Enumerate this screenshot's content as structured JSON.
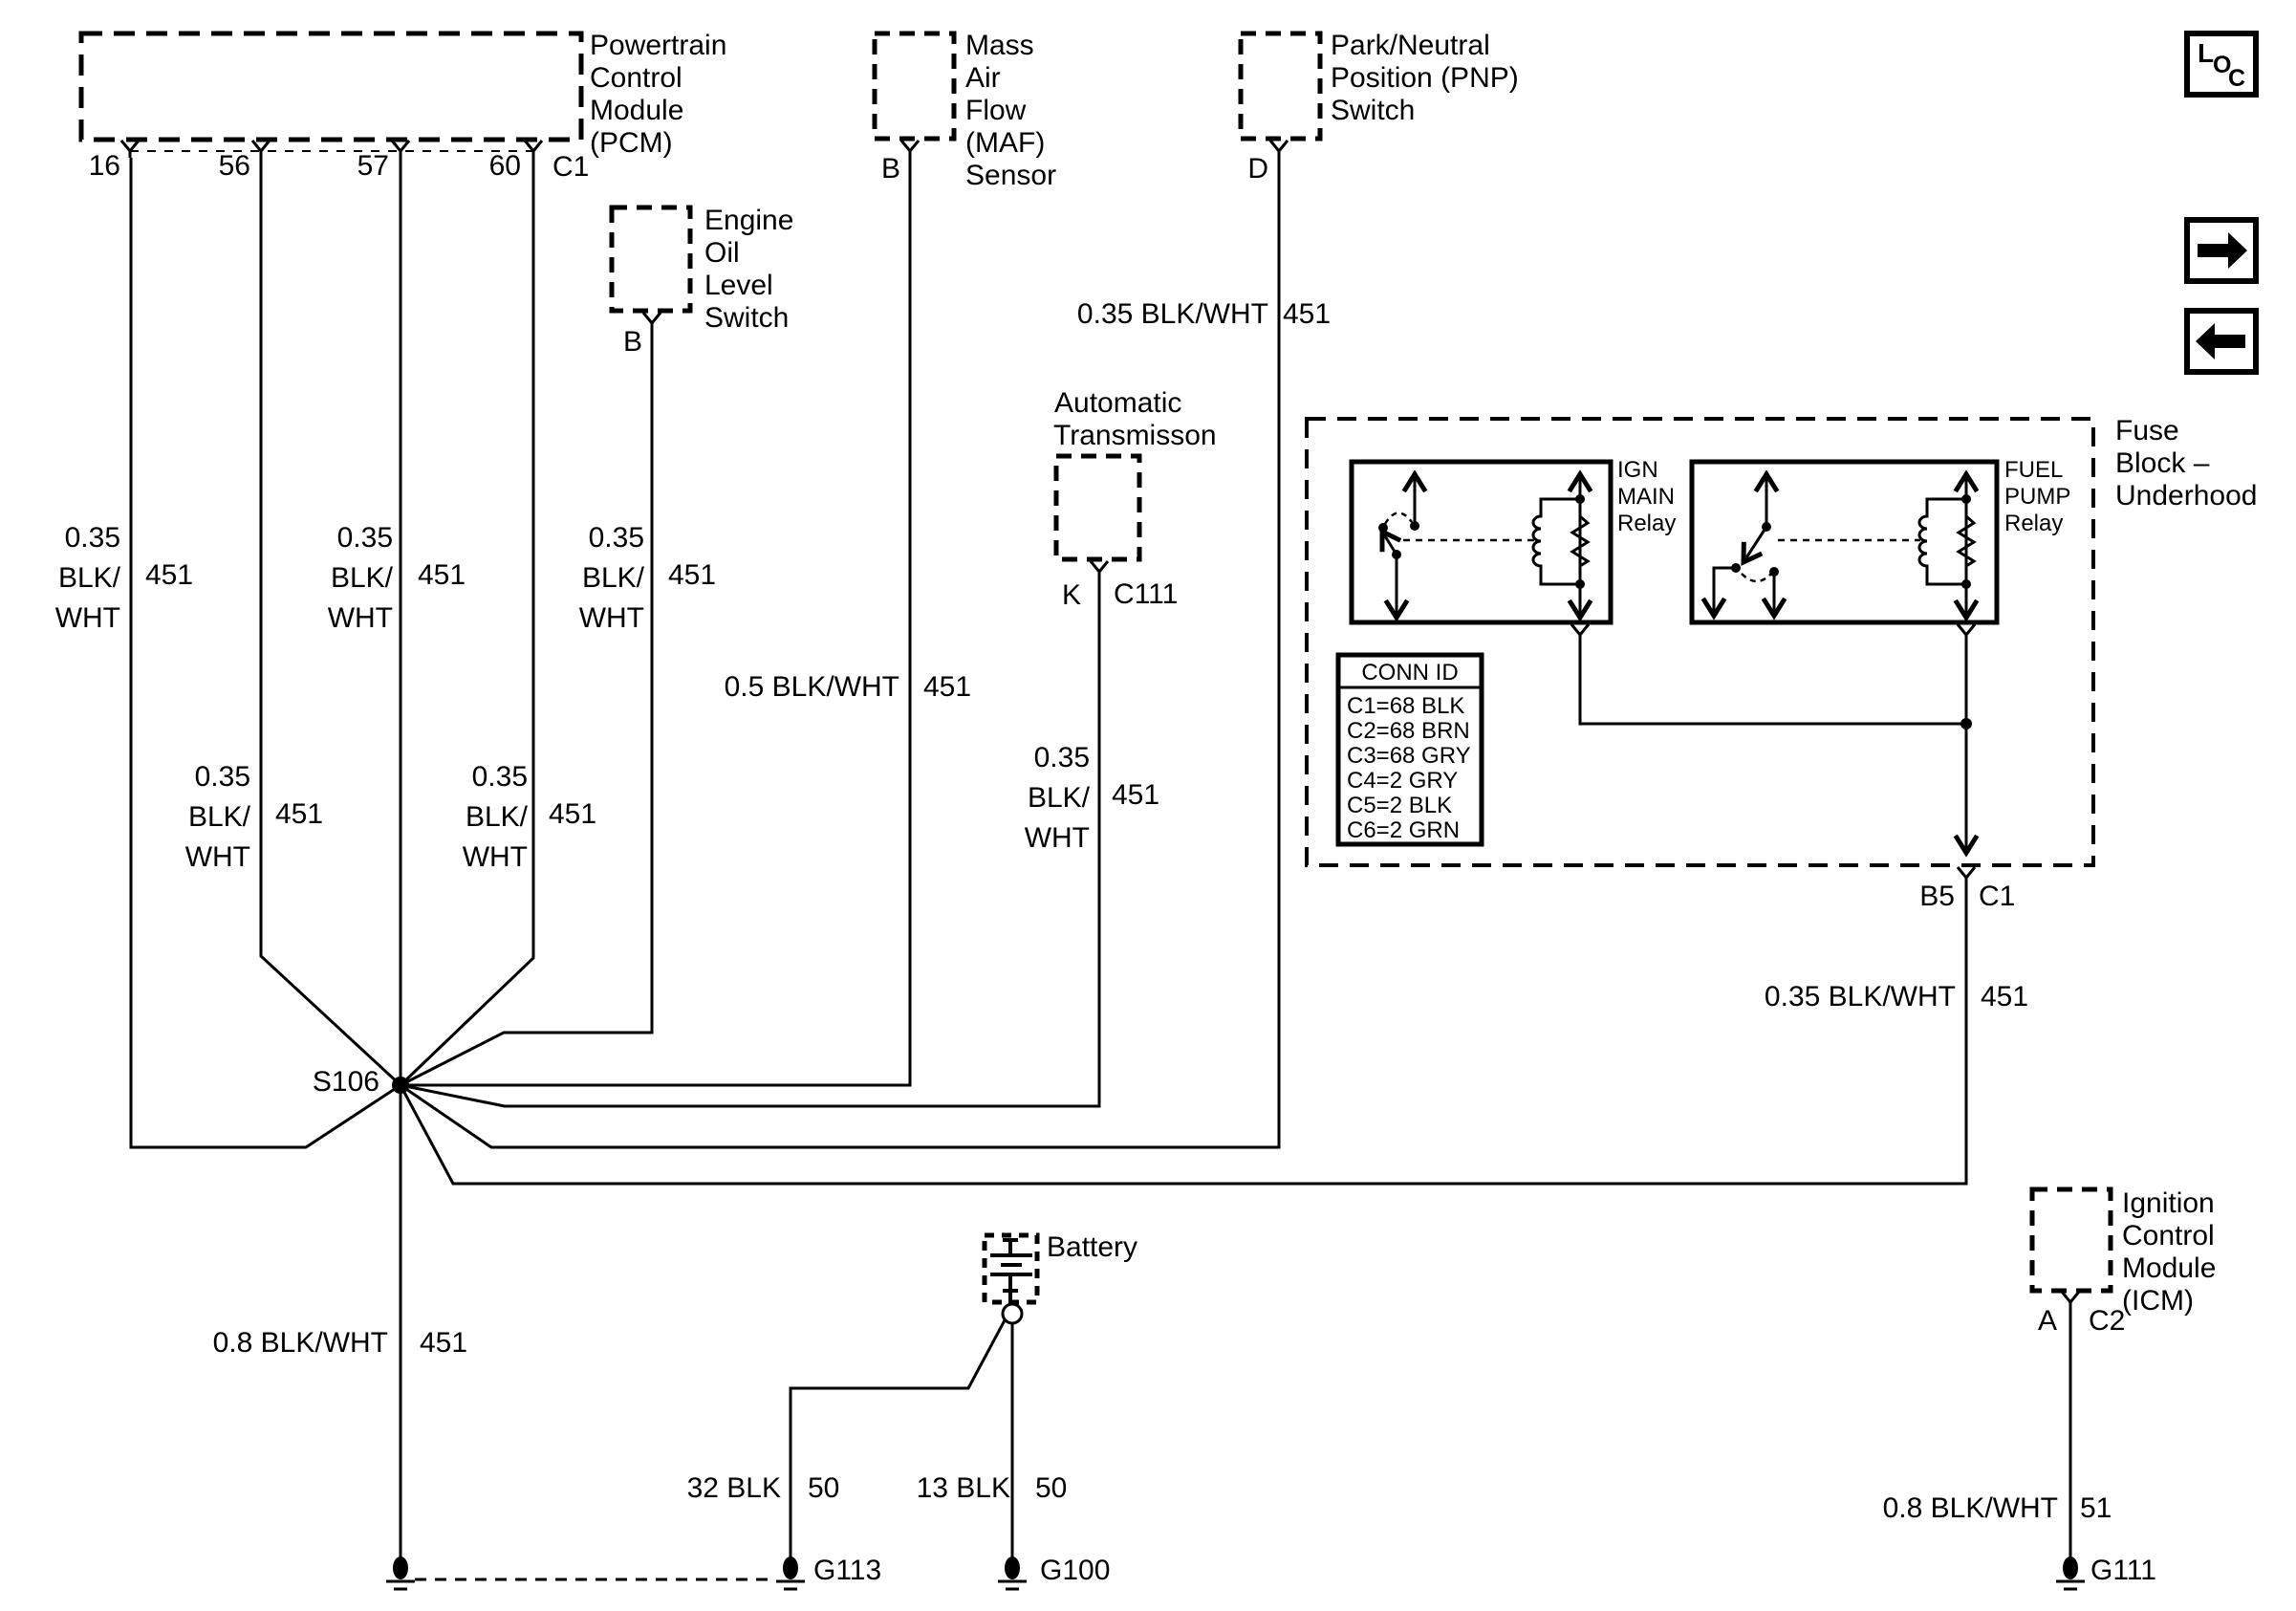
{
  "pcm": {
    "l1": "Powertrain",
    "l2": "Control",
    "l3": "Module",
    "l4": "(PCM)",
    "pin16": "16",
    "pin56": "56",
    "pin57": "57",
    "pin60": "60",
    "conn": "C1"
  },
  "maf": {
    "l1": "Mass",
    "l2": "Air",
    "l3": "Flow",
    "l4": "(MAF)",
    "l5": "Sensor",
    "pin": "B"
  },
  "pnp": {
    "l1": "Park/Neutral",
    "l2": "Position (PNP)",
    "l3": "Switch",
    "pin": "D"
  },
  "oil": {
    "l1": "Engine",
    "l2": "Oil",
    "l3": "Level",
    "l4": "Switch",
    "pin": "B"
  },
  "trans": {
    "l1": "Automatic",
    "l2": "Transmisson",
    "pin": "K",
    "conn": "C111"
  },
  "fuse": {
    "l1": "Fuse",
    "l2": "Block –",
    "l3": "Underhood",
    "ign1": "IGN",
    "ign2": "MAIN",
    "ign3": "Relay",
    "fuel1": "FUEL",
    "fuel2": "PUMP",
    "fuel3": "Relay",
    "exit_pin": "B5",
    "exit_conn": "C1"
  },
  "conn_id": {
    "title": "CONN ID",
    "r1": "C1=68 BLK",
    "r2": "C2=68 BRN",
    "r3": "C3=68 GRY",
    "r4": "C4=2 GRY",
    "r5": "C5=2 BLK",
    "r6": "C6=2 GRN"
  },
  "battery": {
    "label": "Battery"
  },
  "icm": {
    "l1": "Ignition",
    "l2": "Control",
    "l3": "Module",
    "l4": "(ICM)",
    "pin": "A",
    "conn": "C2"
  },
  "splice": {
    "label": "S106"
  },
  "grounds": {
    "g113": "G113",
    "g100": "G100",
    "g111": "G111"
  },
  "labels": {
    "w16": {
      "a": "0.35",
      "b": "BLK/",
      "c": "WHT",
      "ckt": "451"
    },
    "w56": {
      "a": "0.35",
      "b": "BLK/",
      "c": "WHT",
      "ckt": "451"
    },
    "w57": {
      "a": "0.35",
      "b": "BLK/",
      "c": "WHT",
      "ckt": "451"
    },
    "w60": {
      "a": "0.35",
      "b": "BLK/",
      "c": "WHT",
      "ckt": "451"
    },
    "woil": {
      "a": "0.35",
      "b": "BLK/",
      "c": "WHT",
      "ckt": "451"
    },
    "wk": {
      "a": "0.35",
      "b": "BLK/",
      "c": "WHT",
      "ckt": "451"
    },
    "wmaf": {
      "t": "0.5 BLK/WHT",
      "ckt": "451"
    },
    "wpnp": {
      "t": "0.35 BLK/WHT",
      "ckt": "451"
    },
    "wfuse": {
      "t": "0.35 BLK/WHT",
      "ckt": "451"
    },
    "ws106": {
      "t": "0.8 BLK/WHT",
      "ckt": "451"
    },
    "w32": {
      "t": "32 BLK",
      "ckt": "50"
    },
    "w13": {
      "t": "13 BLK",
      "ckt": "50"
    },
    "wicm": {
      "t": "0.8 BLK/WHT",
      "ckt": "51"
    }
  },
  "nav": {
    "loc_l": "L",
    "loc_o": "O",
    "loc_c": "C"
  }
}
